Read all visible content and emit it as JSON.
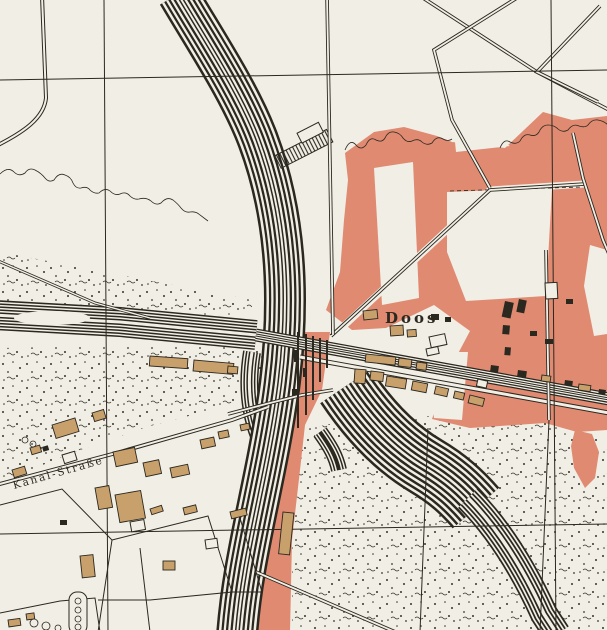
{
  "map": {
    "description": "Scanned historical town-plan / topographic map sheet",
    "labels": {
      "village": "Doos",
      "street": "Kanal-Straße"
    },
    "colors": {
      "paper": "#f1eee6",
      "zone_red": "#df8a71",
      "building_tan": "#c7a06b",
      "ink": "#2b2820",
      "stipple": "#35322a"
    }
  }
}
